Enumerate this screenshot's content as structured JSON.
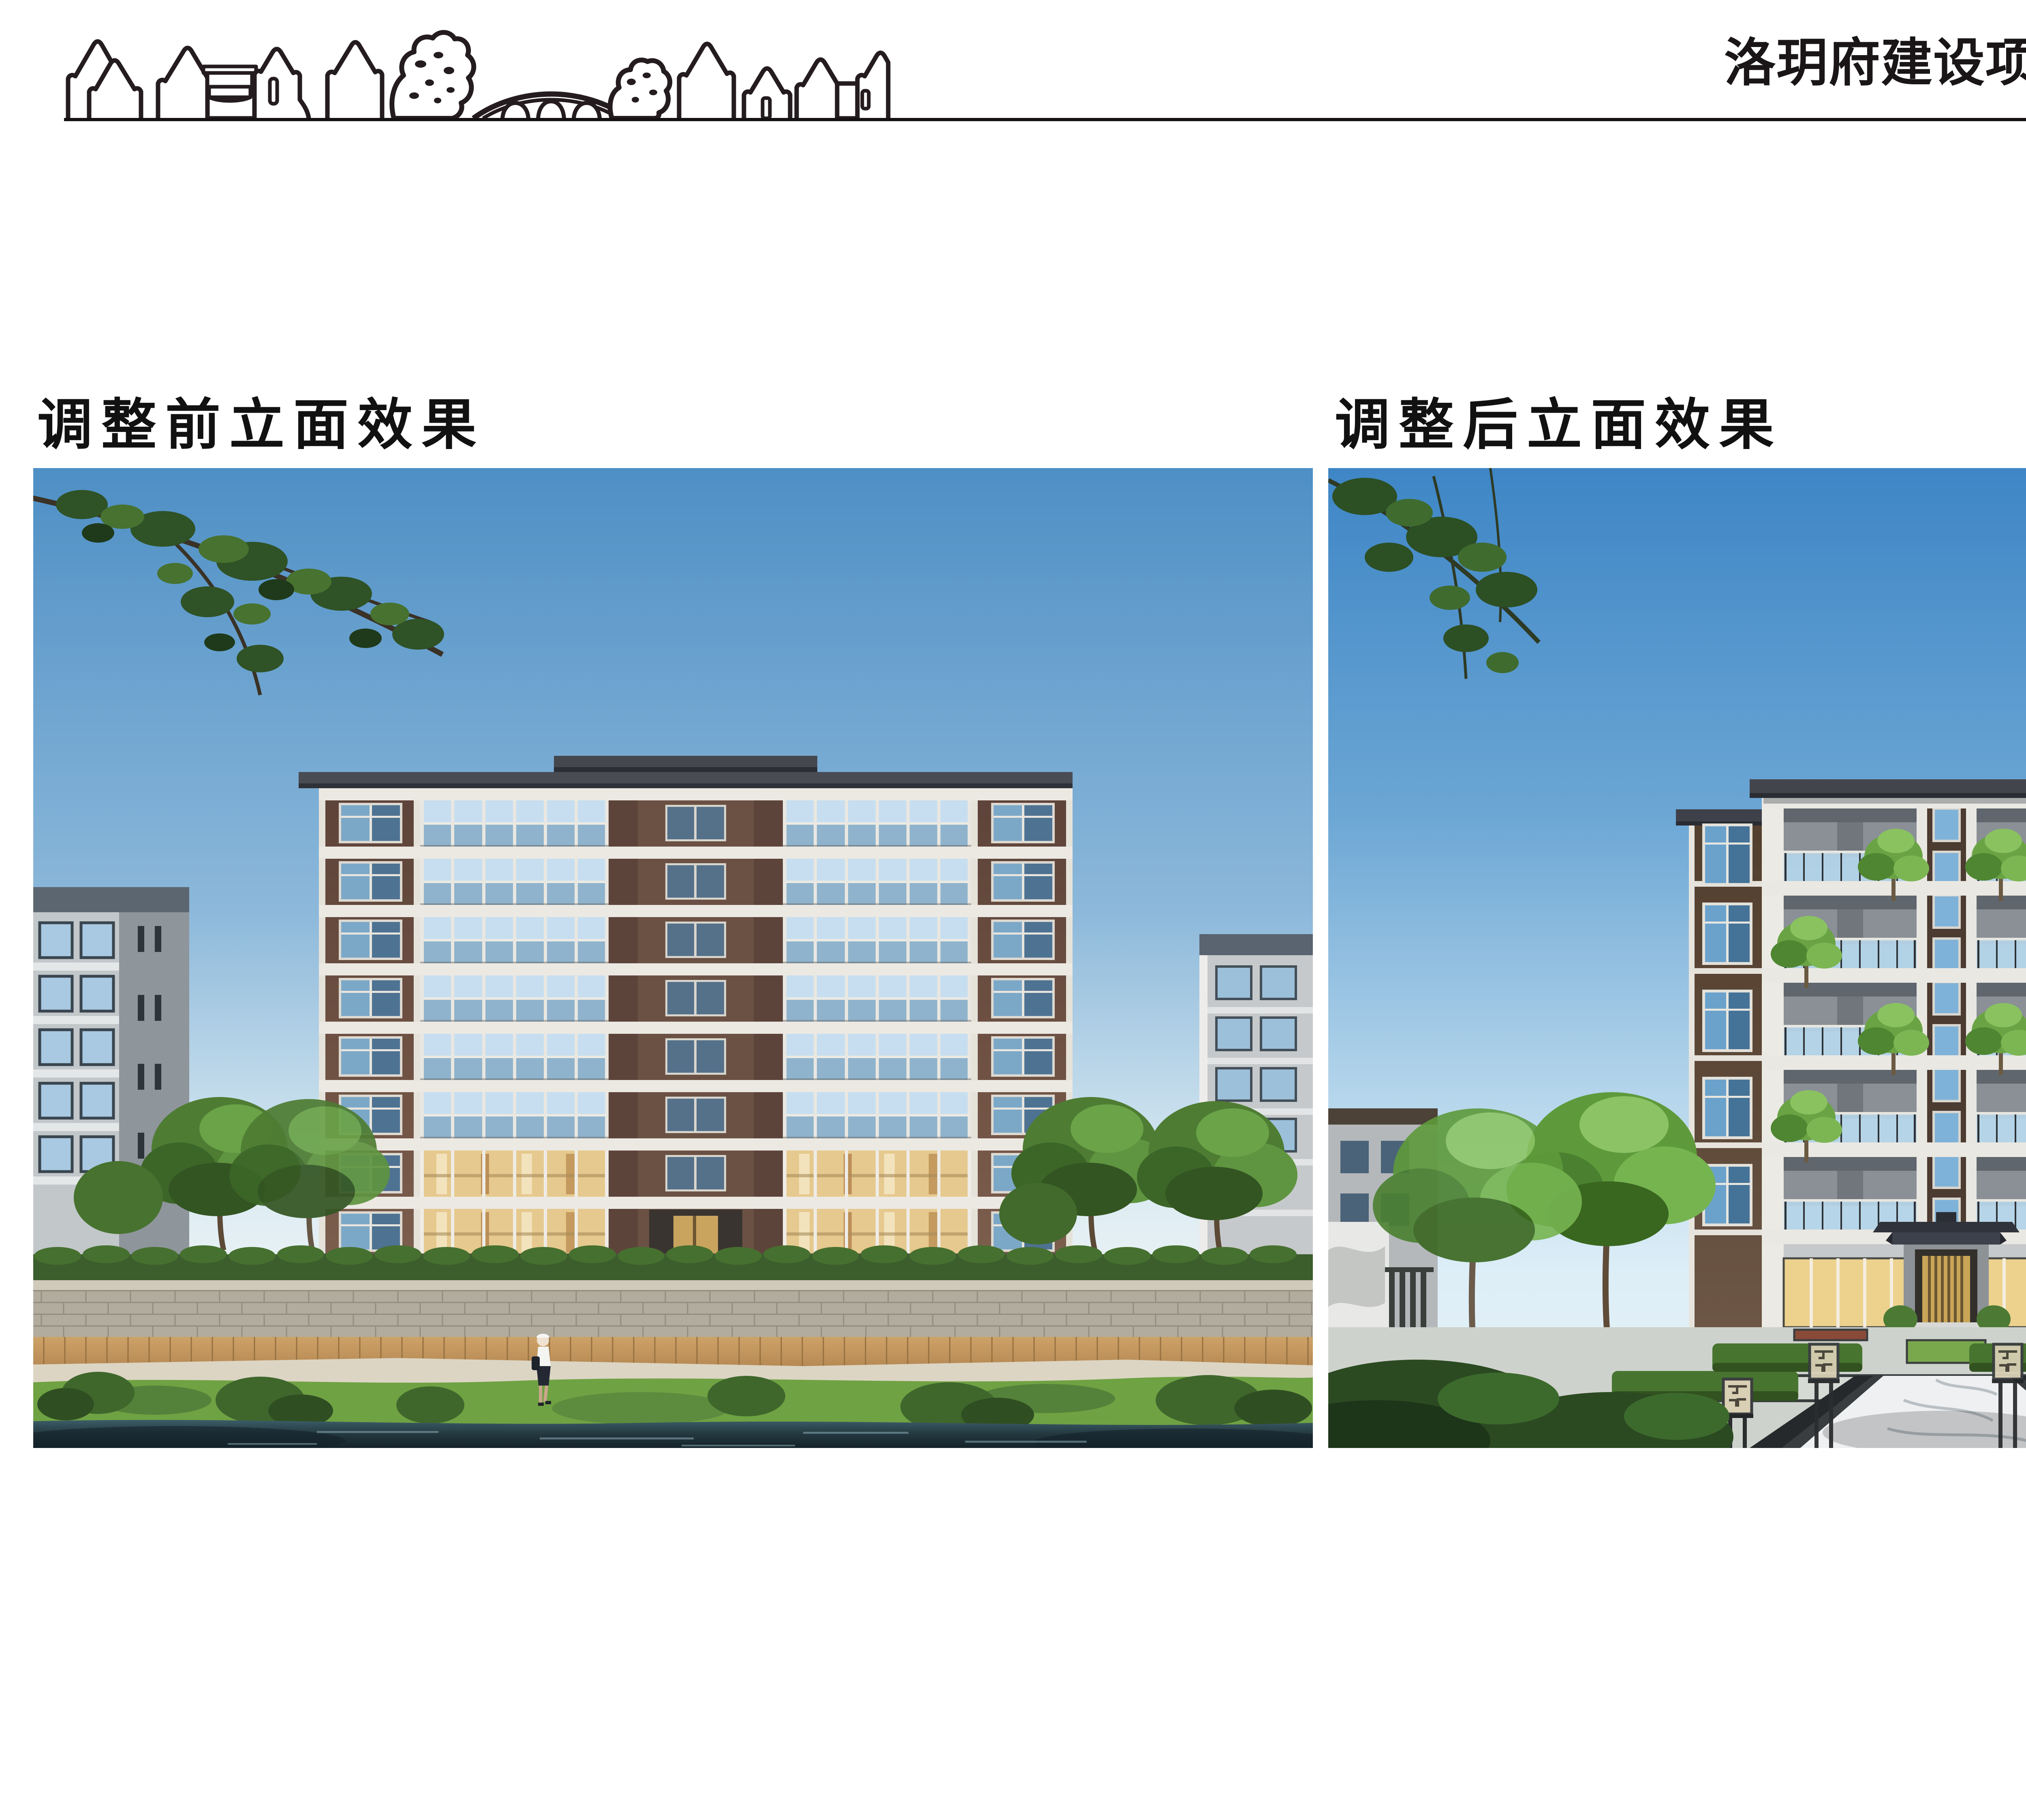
{
  "header": {
    "title": "洛玥府建设项目方案设计调整公示",
    "logo_name": "traditional-village-skyline-drawing"
  },
  "panels": {
    "before": {
      "label": "调整前立面效果"
    },
    "after": {
      "label": "调整后立面效果"
    }
  },
  "palette": {
    "title_color": "#1a1618",
    "divider_color": "#151114",
    "page_bg": "#ffffff",
    "sky_blue_before": "#4e8fc5",
    "sky_blue_after": "#3e86c6",
    "brick_brown": "#64493c",
    "facade_white": "#ece9e3",
    "glass_blue": "#a9cde6",
    "lit_window_warm": "#e6c98e",
    "roof_dark": "#3c3f46",
    "foliage_green": "#4e7c33",
    "lawn_green": "#7aa94e",
    "water_dark": "#2d4751",
    "boardwalk_tan": "#c59a60",
    "stone_wall_gray": "#b2ac9f",
    "paving_light": "#d2d6d0"
  }
}
